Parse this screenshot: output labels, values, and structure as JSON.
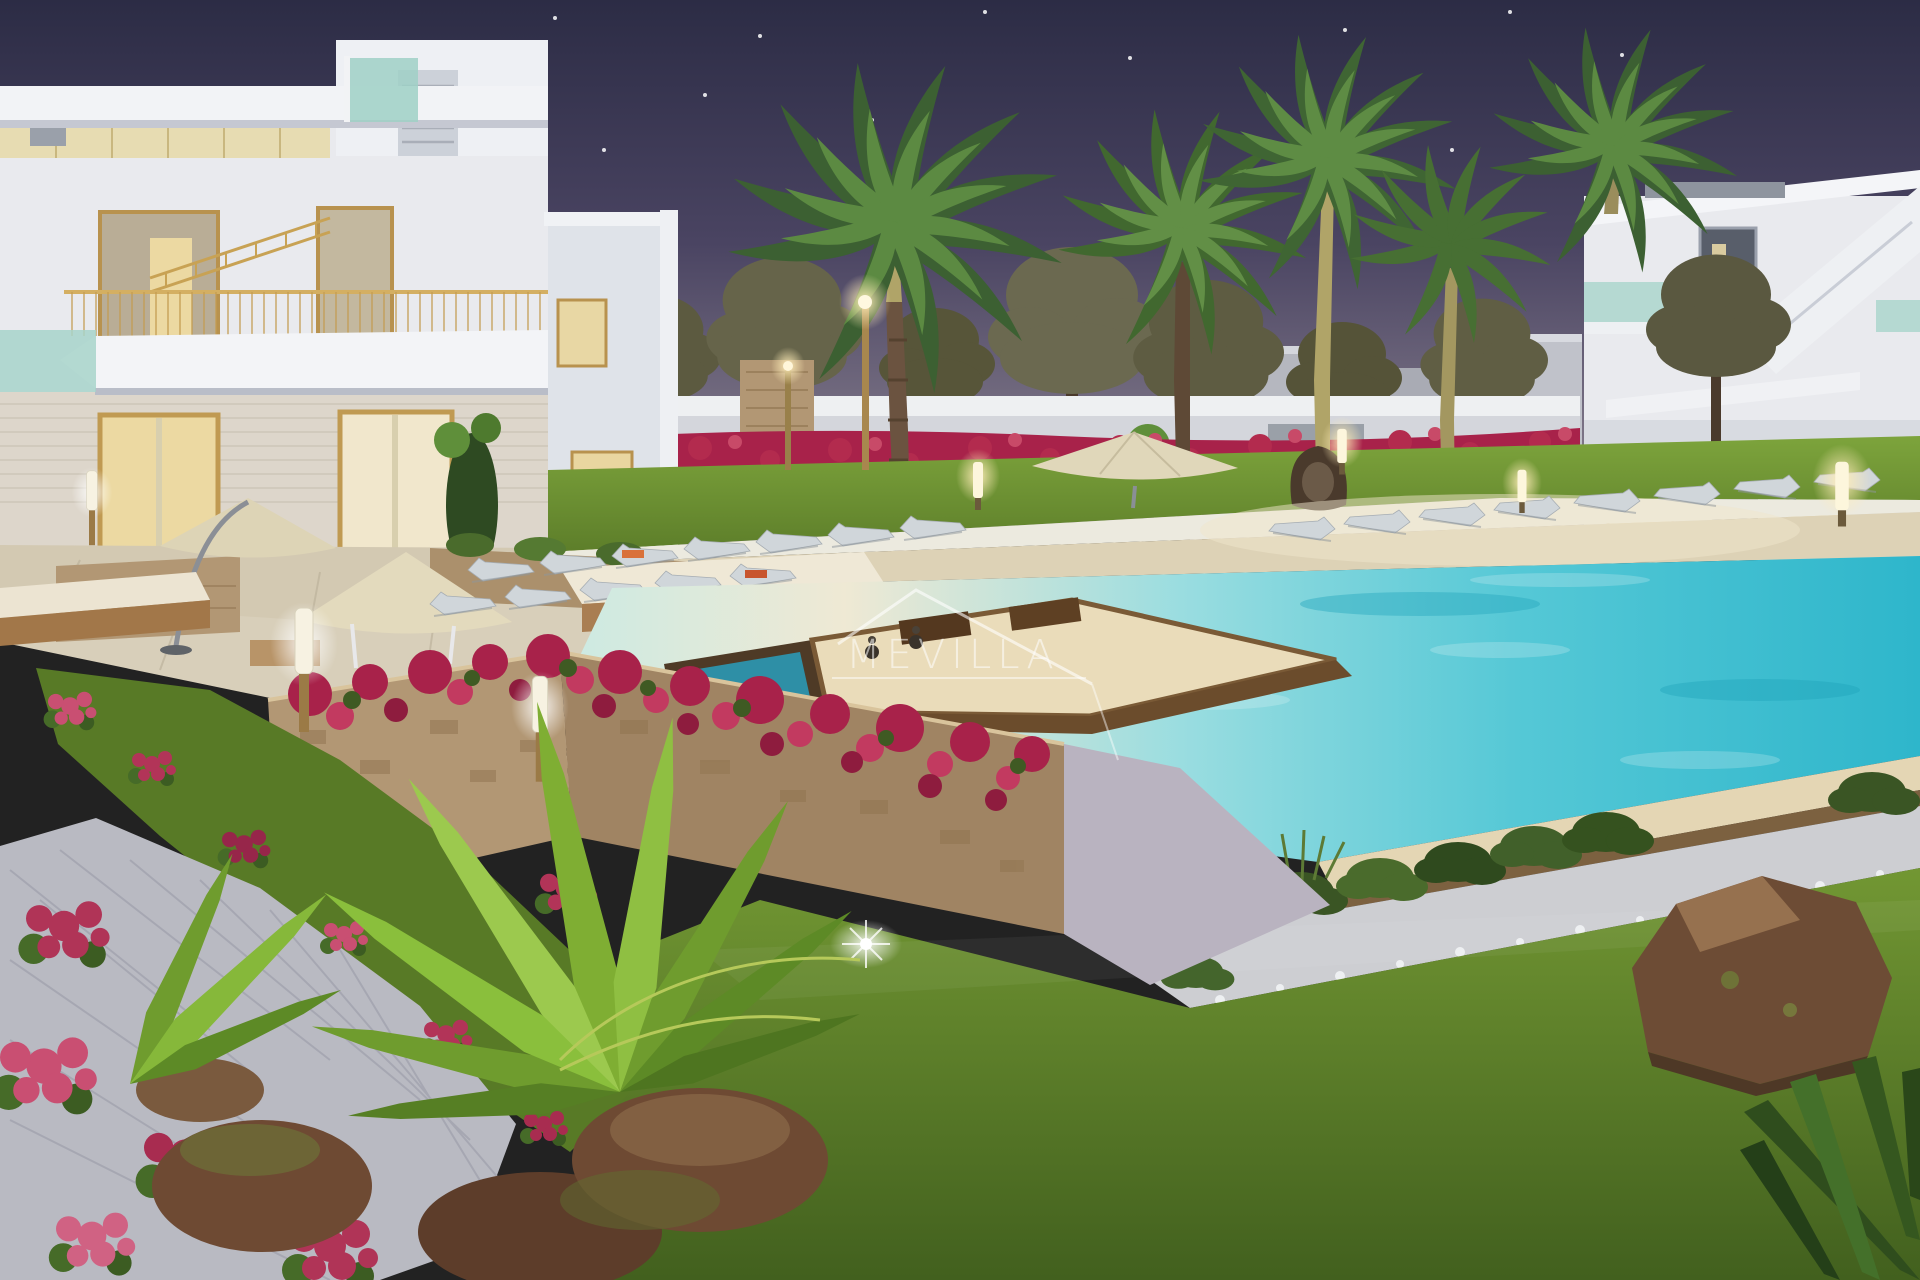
{
  "watermark": {
    "text": "MEVILLA",
    "color": "#ffffff",
    "opacity": "0.55"
  },
  "palette": {
    "sky_top": "#2c2c45",
    "sky_mid": "#4a4462",
    "sky_horizon": "#958c98",
    "building_white": "#e9eaee",
    "building_shadow": "#c9cdd6",
    "window_glow": "#ecd9a2",
    "frame_gold": "#c49d52",
    "glass_teal": "#a7d4ca",
    "pool_shallow": "#efe9d4",
    "pool_aqua": "#55c8d6",
    "pool_deep": "#2eb6cb",
    "deck_beige": "#ddd2b6",
    "lawn_light": "#7da43c",
    "lawn_dark": "#42601e",
    "bougainvillea": "#a8224a",
    "flower_pink": "#c94f72",
    "stone_tan": "#b29774",
    "stone_dark": "#a08463",
    "path_gray": "#b9bac2",
    "palm_green": "#3c6032",
    "palm_bright": "#8abf3c",
    "trunk_brown": "#6b5340",
    "pine_olive": "#5e5c42",
    "lamp_glow": "#ffedb8",
    "rock_brown": "#6d4c35",
    "wall_white": "#d4d6dc",
    "lounger_gray": "#d0d6da",
    "rattan_brown": "#a97e52",
    "cushion_cream": "#ece4d2",
    "umbrella_beige": "#e0d7ba",
    "towel_orange": "#d9713a"
  }
}
